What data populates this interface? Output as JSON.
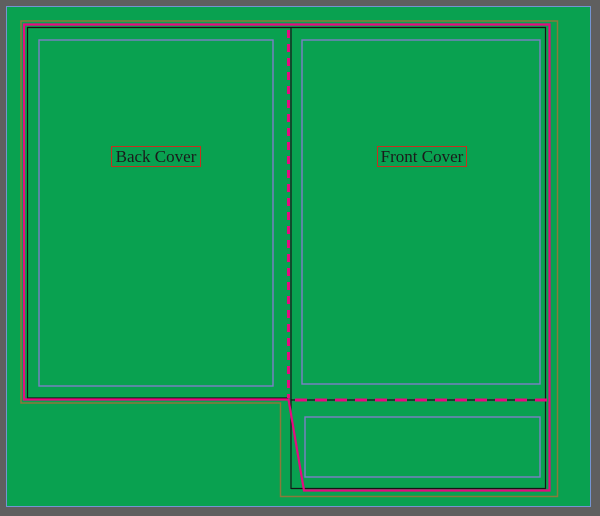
{
  "viewer": {
    "background_color": "#5f5f5f",
    "artboard_color": "#09a150",
    "page_edge_color": "#7495d2"
  },
  "panels": {
    "back": {
      "label": "Back Cover"
    },
    "front": {
      "label": "Front Cover"
    }
  },
  "dieline": {
    "cut_line_color": "#e60a80",
    "fold_line_color": "#e60a80",
    "inner_line_color": "#151515",
    "bleed_line_color": "#8a793b",
    "guide_color": "#7d7fc7",
    "label_border_color": "#c5301f",
    "label_text_color": "#1b1b1b"
  }
}
